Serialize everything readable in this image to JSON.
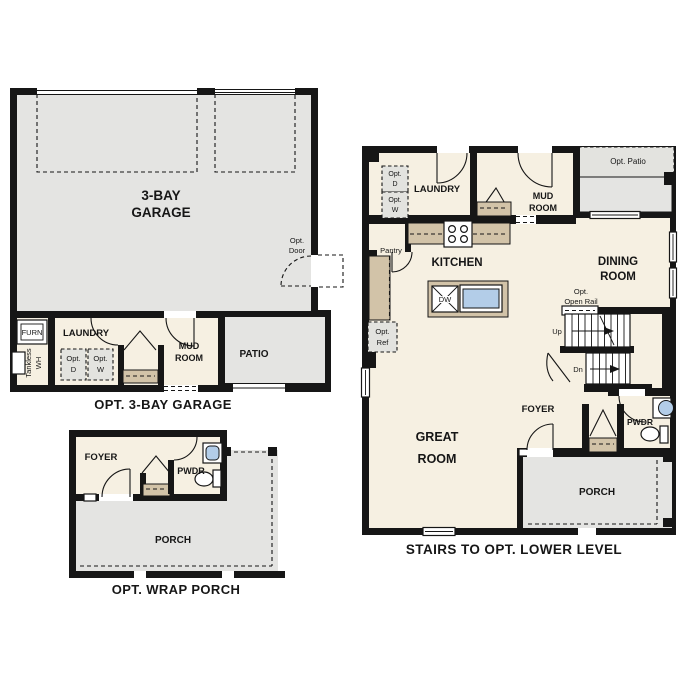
{
  "colors": {
    "wall": "#161616",
    "interior_cream": "#f6f0e2",
    "exterior_gray": "#e4e4e2",
    "counter_tan": "#d2c3a8",
    "fixture_blue": "#b3cde8",
    "option_box_gray": "#e3e3df"
  },
  "garage_plan": {
    "caption": "OPT. 3-BAY GARAGE",
    "labels": {
      "garage_l1": "3-BAY",
      "garage_l2": "GARAGE",
      "laundry": "LAUNDRY",
      "mud_l1": "MUD",
      "mud_l2": "ROOM",
      "patio": "PATIO",
      "furn": "FURN",
      "tankless_l1": "Tankless",
      "tankless_l2": "WH",
      "opt_d_l1": "Opt.",
      "opt_d_l2": "D",
      "opt_w_l1": "Opt.",
      "opt_w_l2": "W",
      "opt_door_l1": "Opt.",
      "opt_door_l2": "Door"
    }
  },
  "wrap_porch_plan": {
    "caption": "OPT. WRAP PORCH",
    "labels": {
      "foyer": "FOYER",
      "pwdr": "PWDR",
      "porch": "PORCH"
    }
  },
  "main_plan": {
    "caption": "STAIRS TO OPT. LOWER LEVEL",
    "labels": {
      "laundry": "LAUNDRY",
      "opt_d_l1": "Opt.",
      "opt_d_l2": "D",
      "opt_w_l1": "Opt.",
      "opt_w_l2": "W",
      "mud_l1": "MUD",
      "mud_l2": "ROOM",
      "opt_patio": "Opt. Patio",
      "pantry": "Pantry",
      "kitchen": "KITCHEN",
      "dw": "DW",
      "dining_l1": "DINING",
      "dining_l2": "ROOM",
      "opt_open_rail_l1": "Opt.",
      "opt_open_rail_l2": "Open Rail",
      "up": "Up",
      "dn": "Dn",
      "opt_ref_l1": "Opt.",
      "opt_ref_l2": "Ref",
      "foyer": "FOYER",
      "pwdr": "PWDR",
      "great_l1": "GREAT",
      "great_l2": "ROOM",
      "porch": "PORCH"
    }
  }
}
